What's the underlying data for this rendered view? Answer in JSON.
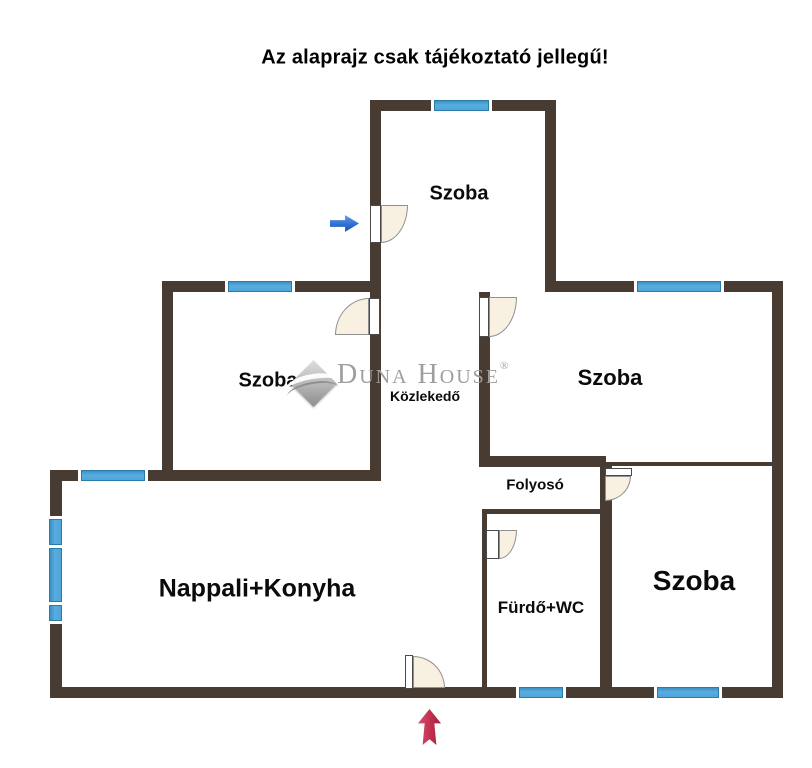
{
  "title": "Az alaprajz csak tájékoztató jellegű!",
  "watermark": {
    "brand": "Duna House",
    "registered_mark": "®",
    "logo": "duna-house-diamond-logo"
  },
  "rooms": {
    "szoba_top": {
      "label": "Szoba"
    },
    "szoba_left": {
      "label": "Szoba"
    },
    "szoba_right": {
      "label": "Szoba"
    },
    "szoba_bottom_right": {
      "label": "Szoba"
    },
    "kozlekedo": {
      "label": "Közlekedő"
    },
    "folyoso": {
      "label": "Folyosó"
    },
    "nappali_konyha": {
      "label": "Nappali+Konyha"
    },
    "furdo_wc": {
      "label": "Fürdő+WC"
    }
  },
  "icons": {
    "side_entrance": "blue-right-arrow-icon",
    "main_entrance": "red-up-arrow-icon"
  },
  "colors": {
    "wall": "#483B31",
    "window-fill": "#4FA5D8",
    "window-border": "#2A7CA8",
    "door-fill": "#F8F1E1",
    "door-border": "#909090",
    "arrow-blue": "#2E6FD0",
    "arrow-blue-dark": "#17356E",
    "arrow-red": "#C23050",
    "watermark-gray": "#9E9E9E",
    "title-color": "#000000"
  }
}
